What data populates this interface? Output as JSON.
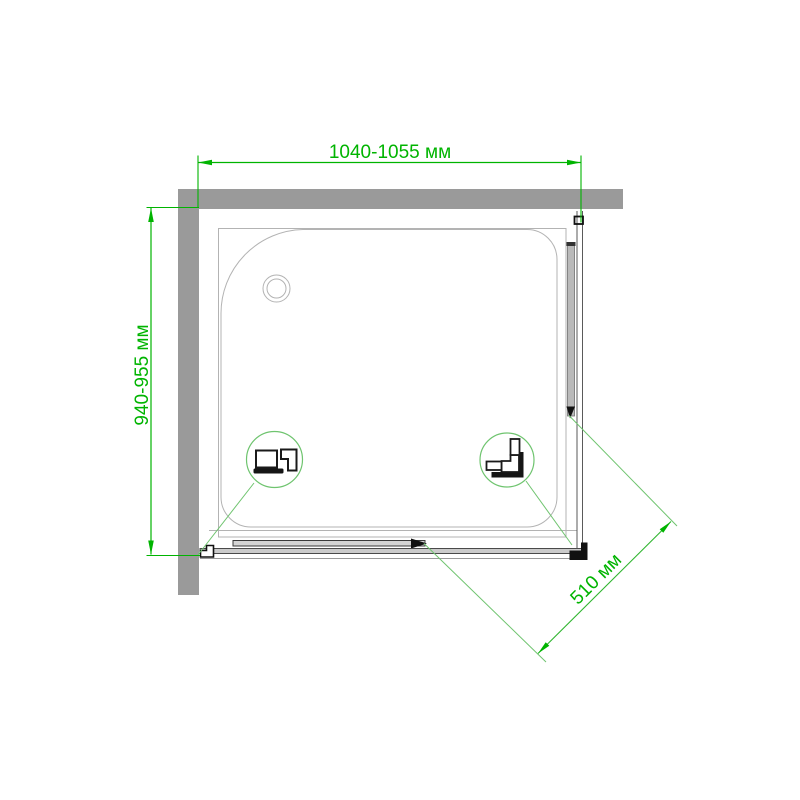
{
  "diagram": {
    "labels": {
      "width": "1040-1055 мм",
      "depth": "940-955 мм",
      "opening": "510 мм"
    },
    "colors": {
      "dimension_green": "#00b400",
      "callout_green": "#6fc46f",
      "wall_gray": "#9a9a9a",
      "tray_line_gray": "#b3b3b3",
      "profile_dark": "#1a1a1a"
    },
    "icons": {
      "drain": "drain-circle-icon",
      "left_detail": "wall-profile-section-icon",
      "right_detail": "corner-profile-section-icon"
    }
  }
}
